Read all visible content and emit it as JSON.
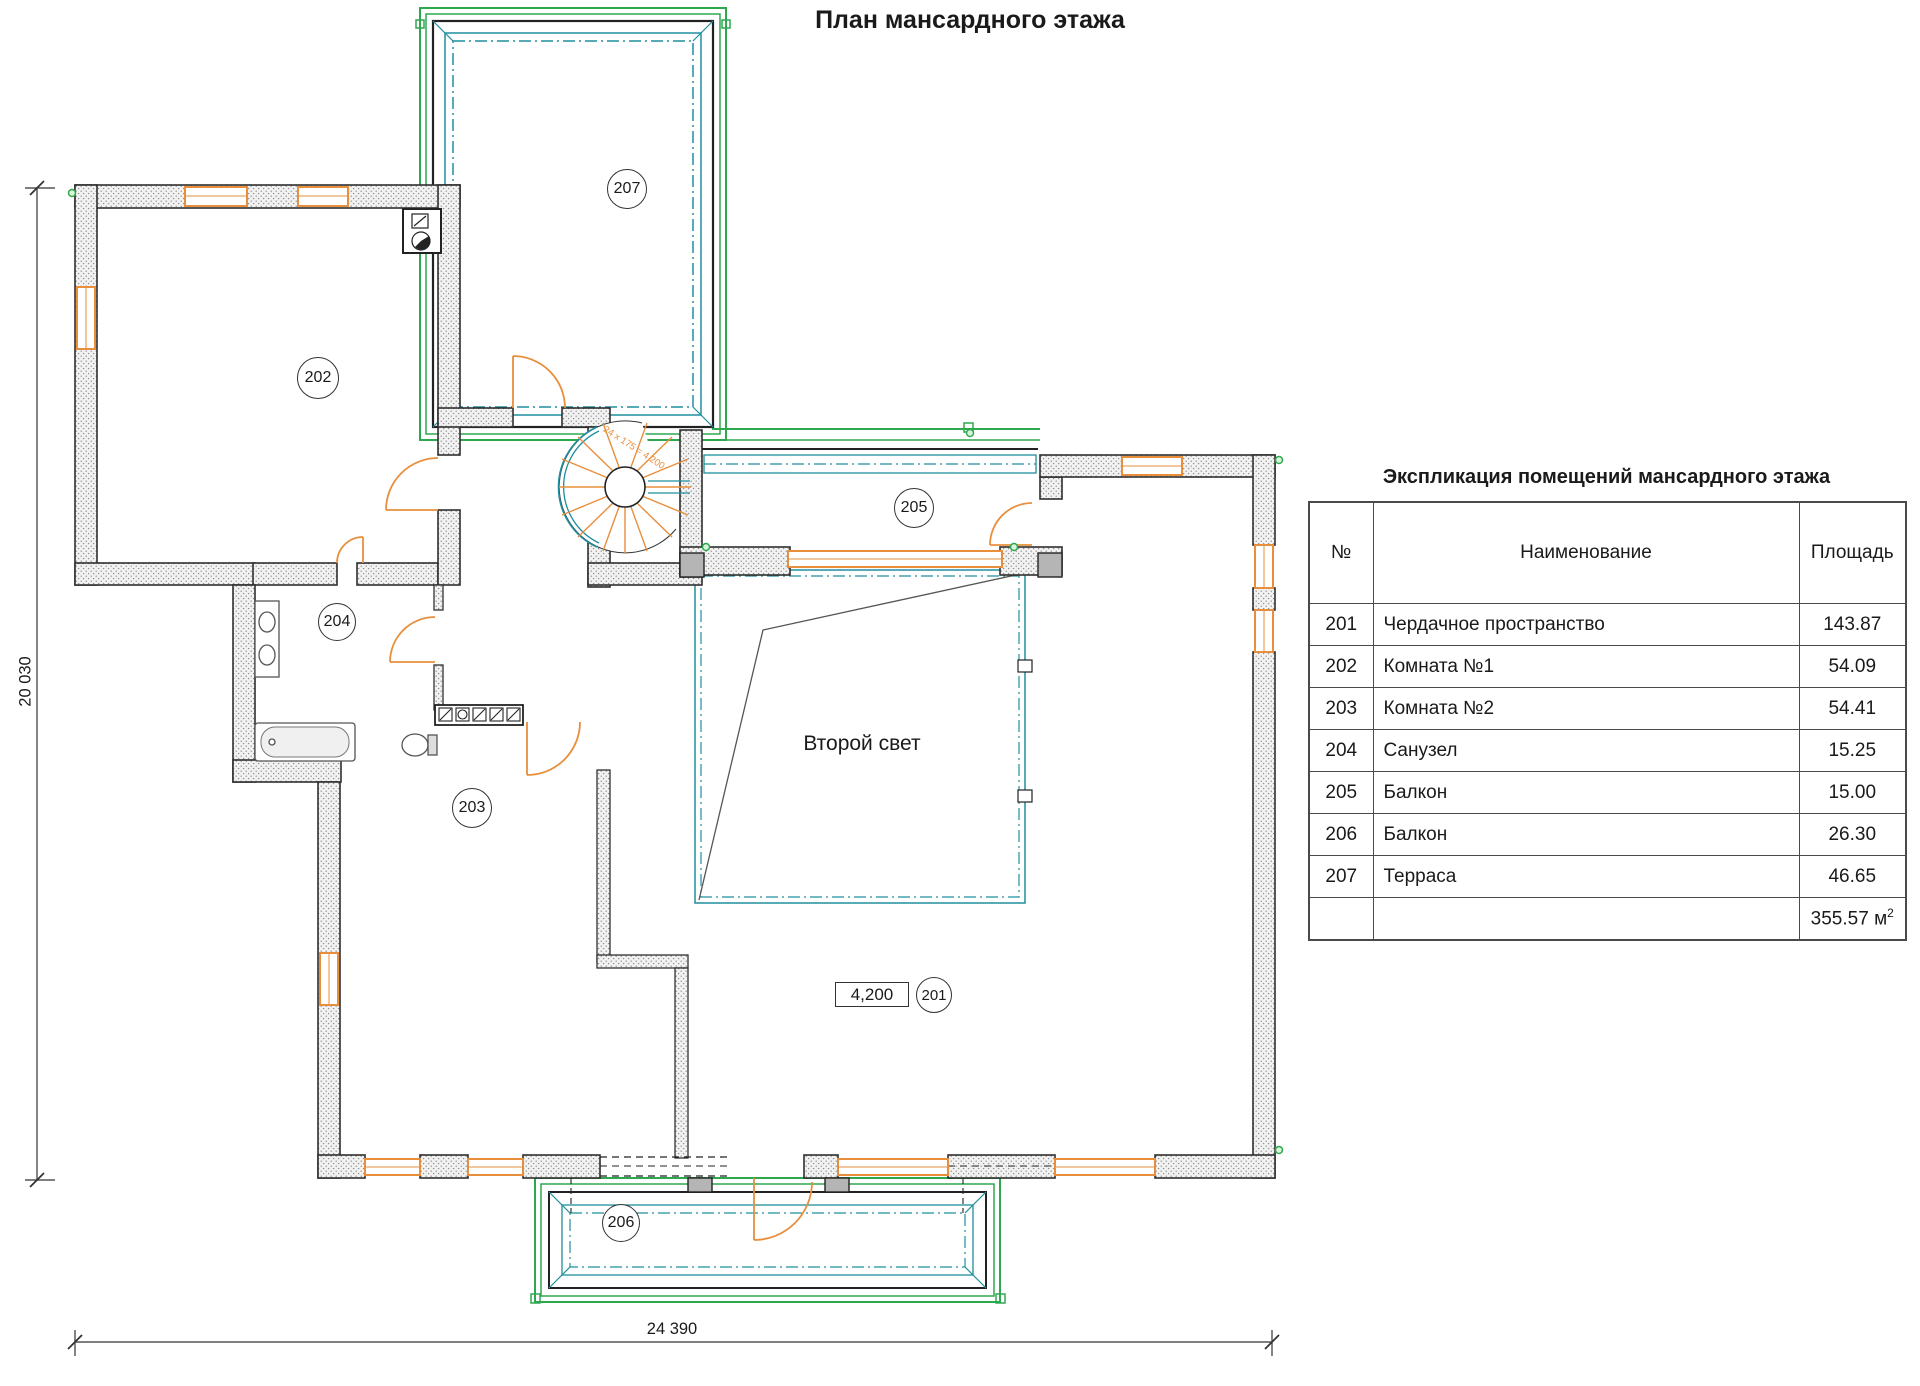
{
  "page_title": "План мансардного этажа",
  "plan": {
    "bubbles": {
      "r201": "201",
      "r202": "202",
      "r203": "203",
      "r204": "204",
      "r205": "205",
      "r206": "206",
      "r207": "207"
    },
    "labels": {
      "second_light": "Второй свет",
      "elevation": "4,200",
      "stair_note": "24 х 175 = 4 200"
    },
    "dimensions": {
      "vertical": "20 030",
      "horizontal": "24 390"
    }
  },
  "table": {
    "title": "Экспликация помещений мансардного этажа",
    "columns": [
      "№",
      "Наименование",
      "Площадь"
    ],
    "rows": [
      {
        "num": "201",
        "name": "Чердачное пространство",
        "area": "143.87"
      },
      {
        "num": "202",
        "name": "Комната №1",
        "area": "54.09"
      },
      {
        "num": "203",
        "name": "Комната №2",
        "area": "54.41"
      },
      {
        "num": "204",
        "name": "Санузел",
        "area": "15.25"
      },
      {
        "num": "205",
        "name": "Балкон",
        "area": "15.00"
      },
      {
        "num": "206",
        "name": "Балкон",
        "area": "26.30"
      },
      {
        "num": "207",
        "name": "Терраса",
        "area": "46.65"
      }
    ],
    "total": {
      "value": "355.57 м",
      "sup": "2"
    }
  },
  "colors": {
    "accent_orange": "#e78f3c",
    "accent_green": "#2ea84e",
    "accent_teal": "#1e8f9e",
    "wall_outline": "#2f2f2f"
  }
}
